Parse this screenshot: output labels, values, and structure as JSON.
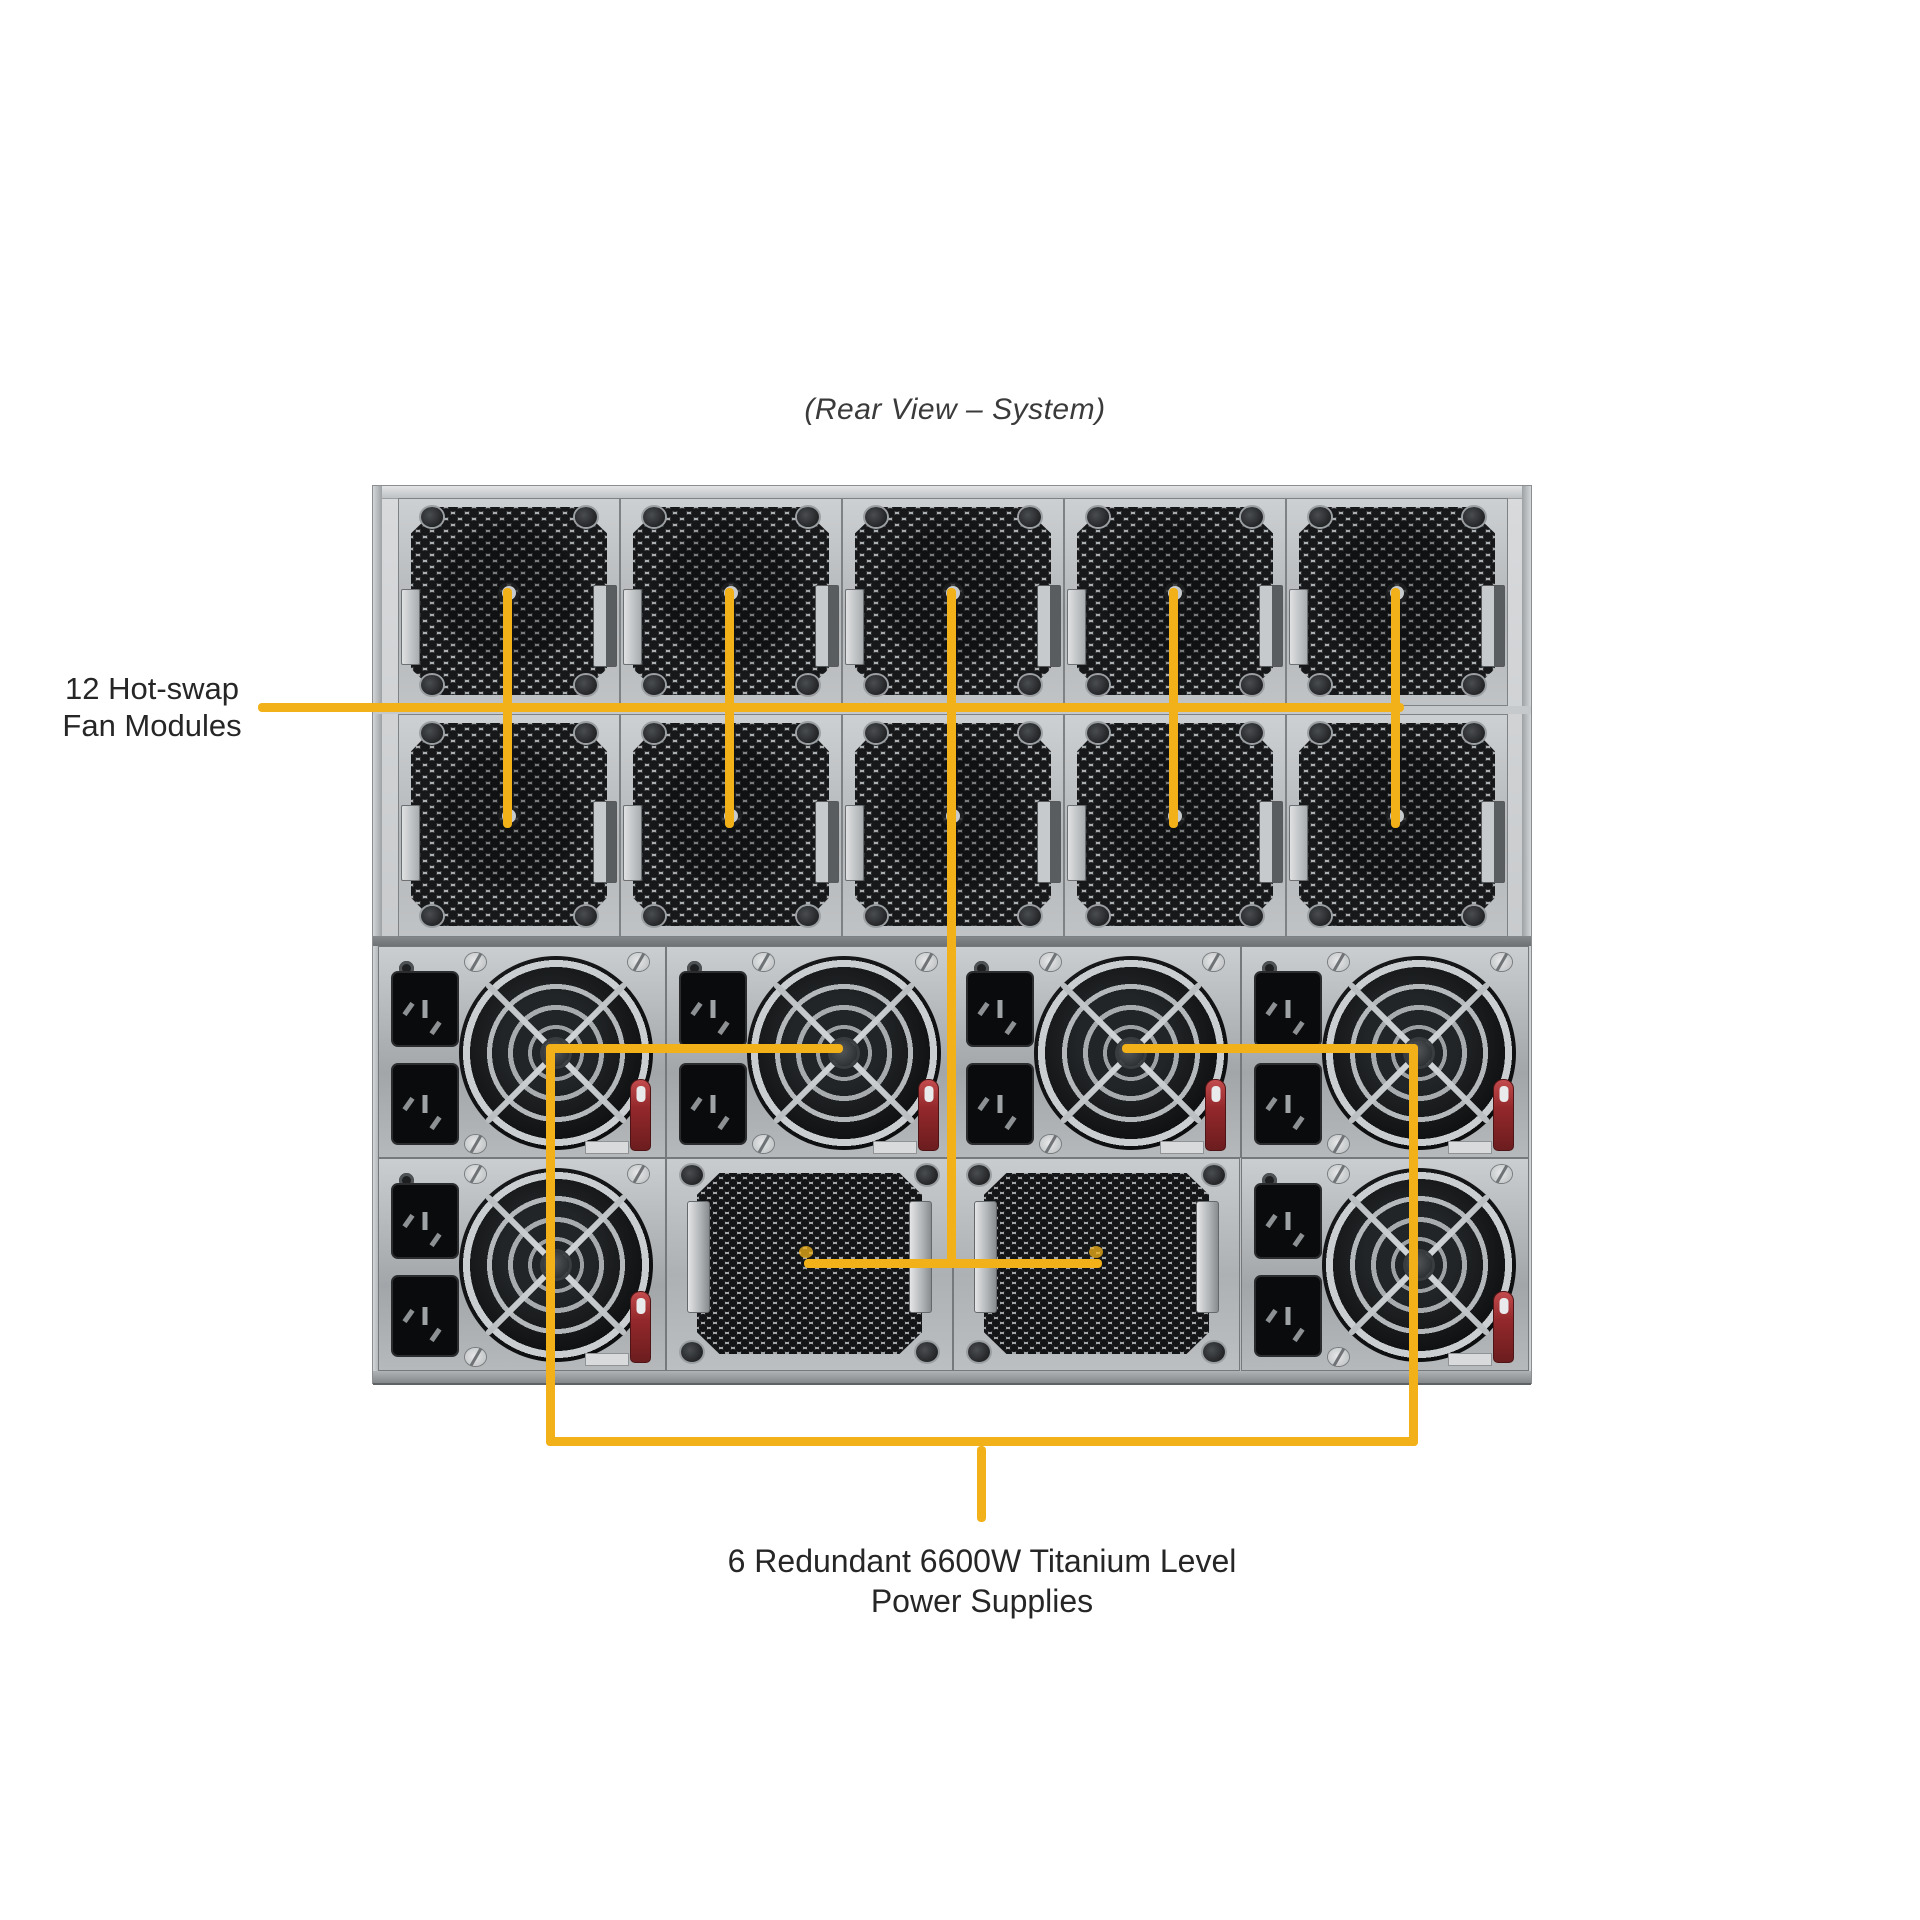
{
  "title": "(Rear View – System)",
  "callouts": {
    "fan_modules": {
      "line1": "12 Hot-swap",
      "line2": "Fan Modules"
    },
    "power_supplies": {
      "line1": "6 Redundant 6600W Titanium Level",
      "line2": "Power Supplies"
    }
  },
  "colors": {
    "callout_yellow": "#F2B118",
    "background": "#FFFFFF",
    "chassis_silver": "#BEC2C4",
    "psu_red_tab": "#93282B"
  }
}
